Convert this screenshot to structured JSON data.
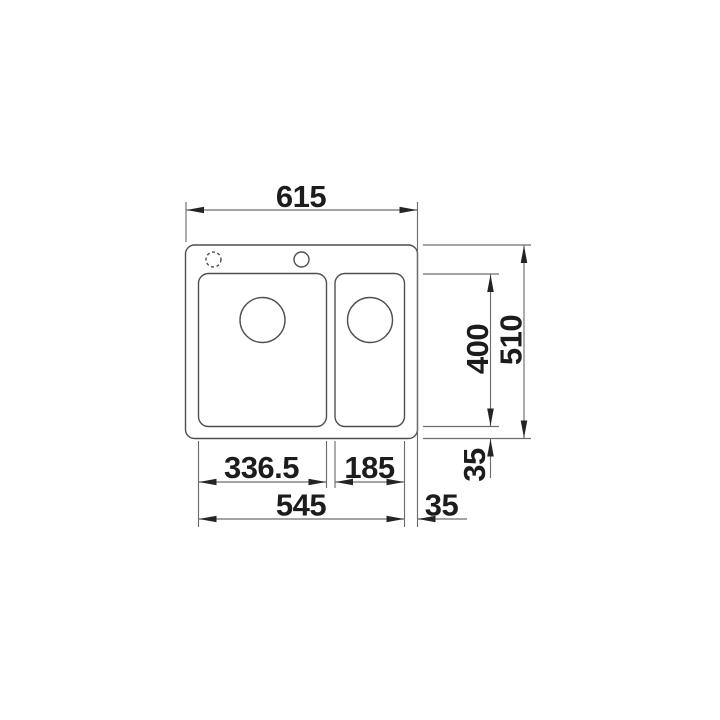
{
  "diagram": {
    "kind": "technical-drawing",
    "subject": "inset kitchen sink with one-and-a-half bowls, plan view",
    "units": "mm",
    "colors": {
      "line": "#6d6d6d",
      "outline": "#4f4f4f",
      "ink": "#1c1c1c",
      "background": "#ffffff"
    },
    "dimensions": {
      "overall_width": "615",
      "overall_depth": "510",
      "bowl_depth": "400",
      "front_rim_depth": "35",
      "main_bowl_width": "336.5",
      "half_bowl_width": "185",
      "bowls_overall_width": "545",
      "right_rim_width": "35"
    }
  }
}
